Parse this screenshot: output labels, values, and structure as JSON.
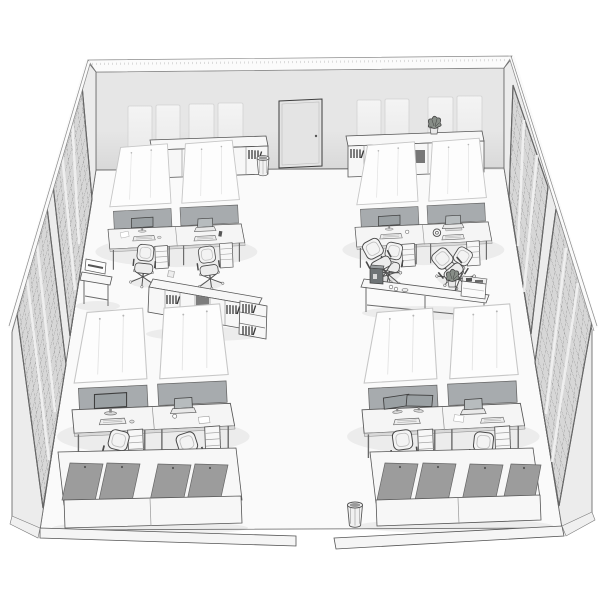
{
  "scene": {
    "type": "isometric-3d-render",
    "subject": "Open-plan office room, isometric cutaway line rendering",
    "render_style": "monochrome architectural illustration, no text"
  },
  "palette": {
    "background": "#ffffff",
    "back_wall": "#e6e6e6",
    "side_wall": "#ececec",
    "door": "#e4e4e4",
    "floor": "#fafafa",
    "window_pane": "#d7d7d7",
    "window_grid": "#8f8f8f",
    "wall_panel": "#f1f1f1",
    "desk_top": "#f5f5f5",
    "privacy_screen": "#fdfdfd",
    "partition": "#a7abae",
    "locker_door": "#9c9c9c",
    "cabinet_body": "#f8f8f8",
    "equipment_dark": "#6f7476",
    "line": "#4a4a4a"
  },
  "room": {
    "back_wall": {
      "door": {
        "count": 1,
        "position": "top center",
        "state": "closed"
      },
      "acoustic_panels": {
        "count": 8,
        "arrangement": "two pairs left of door, two pairs right of door"
      }
    },
    "left_wall": {
      "windows": 2,
      "style": "full-height multi-pane grid"
    },
    "right_wall": {
      "windows": 2,
      "style": "full-height multi-pane grid"
    },
    "front_edge": {
      "type": "cutaway floor plinth",
      "opening": "center gap"
    }
  },
  "furniture": {
    "workstation_clusters": [
      {
        "id": "top-left",
        "desks": 4,
        "privacy_screens": 2,
        "partitions": 2,
        "chairs": 2,
        "pedestals": 2,
        "equipment": [
          "monitor",
          "keyboard",
          "mouse",
          "laptop",
          "phone"
        ],
        "storage": "binder shelf along back wall with waste bin"
      },
      {
        "id": "top-right",
        "desks": 4,
        "privacy_screens": 2,
        "partitions": 2,
        "chairs": 2,
        "pedestals": 2,
        "equipment": [
          "monitor",
          "keyboard",
          "laptop on riser",
          "headphones",
          "mug"
        ],
        "storage": "binder shelf along back wall with plant"
      },
      {
        "id": "bottom-left",
        "desks": 4,
        "privacy_screens": 2,
        "partitions": 2,
        "chairs": 2,
        "pedestals": 2,
        "equipment": [
          "widescreen monitor",
          "keyboard",
          "mouse",
          "laptop",
          "notebook",
          "mug"
        ],
        "storage": "locker row with 4 gray doors at front"
      },
      {
        "id": "bottom-right",
        "desks": 4,
        "privacy_screens": 2,
        "partitions": 2,
        "chairs": 2,
        "pedestals": 2,
        "equipment": [
          "dual monitors",
          "keyboard",
          "laptop",
          "papers"
        ],
        "storage": "locker row with 4 gray doors at front"
      }
    ],
    "shared": [
      {
        "id": "credenza",
        "location": "center-left",
        "contents": "open compartments with binders, tall binder bookcase at end"
      },
      {
        "id": "coffee-counter",
        "location": "center-right",
        "items": [
          "coffee machine",
          "cups",
          "bowl",
          "plant",
          "printer"
        ],
        "chairs": 2
      },
      {
        "id": "printer-stand",
        "location": "against left wall",
        "items": [
          "printer"
        ]
      }
    ],
    "accessories": [
      {
        "id": "trash-bin-back",
        "location": "left of back door"
      },
      {
        "id": "trash-bin-front",
        "location": "front center aisle"
      },
      {
        "id": "plant-shelf",
        "location": "top-right binder shelf"
      },
      {
        "id": "plant-counter",
        "location": "coffee counter"
      }
    ],
    "totals": {
      "desks": 16,
      "chairs": 10,
      "privacy_screens": 8,
      "locker_doors": 8,
      "windows": 4,
      "wall_panels": 8,
      "doors": 1,
      "trash_bins": 2,
      "plants": 2,
      "pedestals": 8
    }
  },
  "labels": {
    "scene": "Isometric rendering of an open-plan office with four 4-desk workstation clusters",
    "door": "Closed door, back wall center",
    "left_windows": "Left wall grid windows",
    "right_windows": "Right wall grid windows",
    "cluster_tl": "Workstation cluster top-left",
    "cluster_tr": "Workstation cluster top-right",
    "cluster_bl": "Workstation cluster bottom-left",
    "cluster_br": "Workstation cluster bottom-right",
    "credenza": "Central credenza with binders",
    "counter": "Coffee / print counter",
    "lockers": "Locker cabinets with gray doors"
  }
}
